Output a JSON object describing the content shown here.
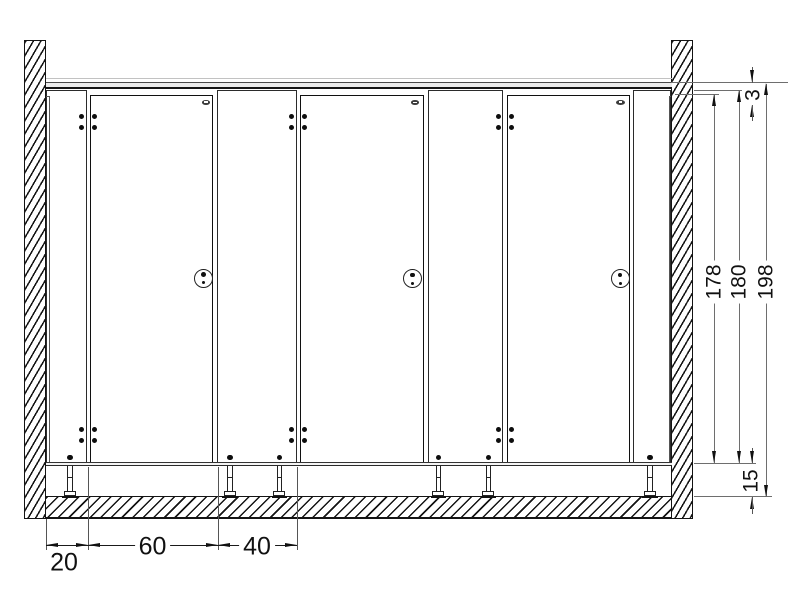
{
  "dimensions": {
    "bottom": [
      {
        "name": "wall-panel-width",
        "value": "20"
      },
      {
        "name": "door-width",
        "value": "60"
      },
      {
        "name": "partition-width",
        "value": "40"
      }
    ],
    "right": [
      {
        "name": "rail-gap",
        "value": "3"
      },
      {
        "name": "door-height",
        "value": "178"
      },
      {
        "name": "panel-height",
        "value": "180"
      },
      {
        "name": "total-height",
        "value": "198"
      },
      {
        "name": "floor-clearance",
        "value": "15"
      }
    ]
  },
  "colors": {
    "line": "#1a1a1a",
    "dim_line": "#6e6e6e",
    "text": "#111111",
    "rail_fill": "#ececec",
    "background": "#ffffff"
  }
}
